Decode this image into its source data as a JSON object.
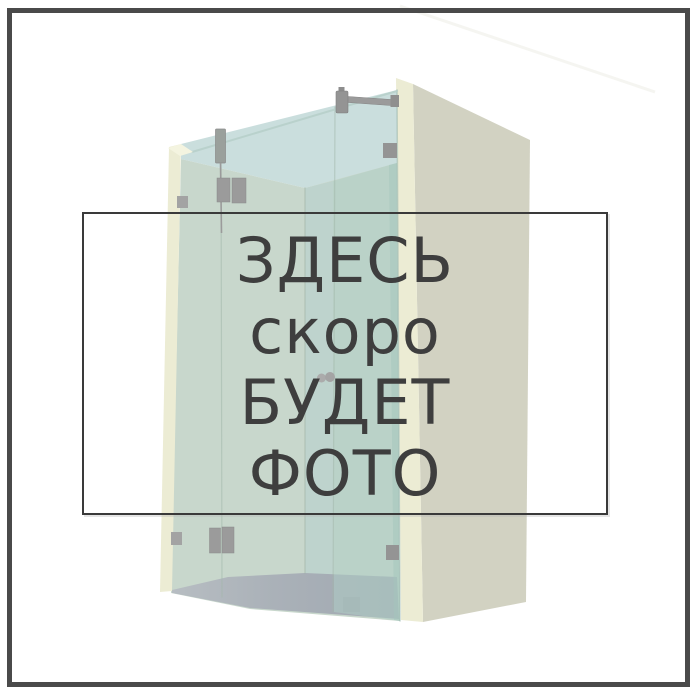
{
  "placeholder": {
    "lines": [
      "ЗДЕСЬ",
      "скоро",
      "БУДЕТ",
      "ФОТО"
    ]
  },
  "illustration": {
    "subject": "walk-in glass shower enclosure 3D render",
    "parts": [
      "left wall pillar",
      "right side wall",
      "glass panels",
      "shower floor",
      "metal support bar",
      "glass clamps",
      "door knob"
    ]
  },
  "colors": {
    "background": "#ffffff",
    "frame_border": "#4a4a4a",
    "text": "#3e3e3e",
    "text_box_border": "#3a3a3a",
    "wall_cream": "#ececd4",
    "wall_face": "#d2d2c2",
    "glass_blue": "#cadedd",
    "glass_green": "#c8d7cc",
    "glass_green_dark": "#aecdc4",
    "floor_gray": "#a7aeb5",
    "metal_gray": "#9b9b9b"
  }
}
